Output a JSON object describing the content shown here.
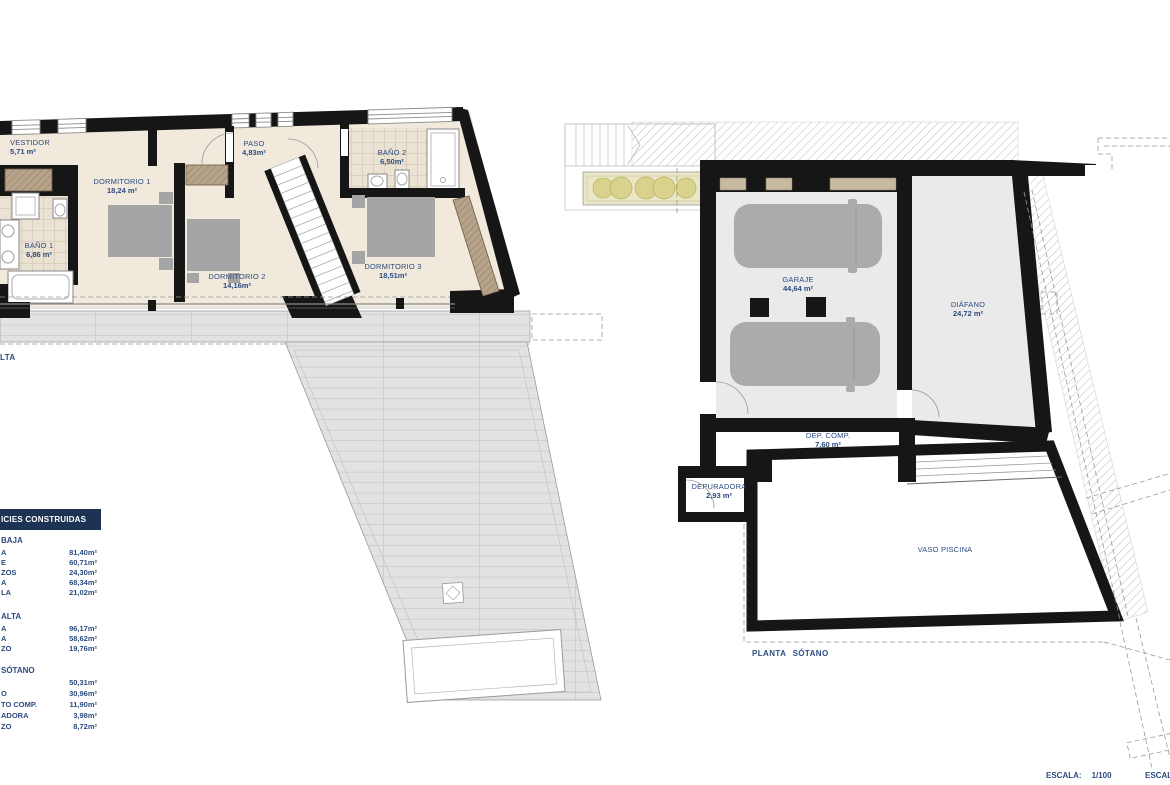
{
  "colors": {
    "label_blue": "#2d4b80",
    "table_header_bg": "#1d3353",
    "wall_black": "#161616",
    "floor_cream": "#f0e9dc",
    "terrace_gray": "#e2e2e2",
    "garage_gray": "#eaeaea",
    "car_gray": "#ababab",
    "planter_green": "#d8d28c"
  },
  "plan_alta": {
    "title_fragment": "LTA",
    "rooms": [
      {
        "name": "VESTIDOR",
        "area": "5,71 m²"
      },
      {
        "name": "BAÑO 1",
        "area": "6,86 m²"
      },
      {
        "name": "DORMITORIO 1",
        "area": "18,24 m²"
      },
      {
        "name": "PASO",
        "area": "4,83m²"
      },
      {
        "name": "BAÑO 2",
        "area": "6,50m²"
      },
      {
        "name": "DORMITORIO 2",
        "area": "14,16m²"
      },
      {
        "name": "DORMITORIO 3",
        "area": "18,51m²"
      }
    ]
  },
  "plan_sotano": {
    "title": "PLANTA SÓTANO",
    "rooms": [
      {
        "name": "GARAJE",
        "area": "44,64 m²"
      },
      {
        "name": "DIÁFANO",
        "area": "24,72 m²"
      },
      {
        "name": "DEP. COMP.",
        "area": "7,60 m²"
      },
      {
        "name": "DEPURADORA",
        "area": "2,93 m²"
      },
      {
        "name": "VASO PISCINA",
        "area": ""
      }
    ]
  },
  "surface_table": {
    "header_fragment": "ICIES CONSTRUIDAS",
    "sections": [
      {
        "title_fragment": "BAJA",
        "rows": [
          {
            "label_fragment": "A",
            "value": "81,40m²"
          },
          {
            "label_fragment": "E",
            "value": "60,71m²"
          },
          {
            "label_fragment": "ZOS",
            "value": "24,30m²"
          },
          {
            "label_fragment": "A",
            "value": "68,34m²"
          },
          {
            "label_fragment": "LA",
            "value": "21,02m²"
          }
        ]
      },
      {
        "title_fragment": "ALTA",
        "rows": [
          {
            "label_fragment": "A",
            "value": "96,17m²"
          },
          {
            "label_fragment": "A",
            "value": "58,62m²"
          },
          {
            "label_fragment": "ZO",
            "value": "19,76m²"
          }
        ]
      },
      {
        "title_fragment": "SÓTANO",
        "rows": [
          {
            "label_fragment": "",
            "value": "50,31m²"
          },
          {
            "label_fragment": "O",
            "value": "30,96m²"
          },
          {
            "label_fragment": "TO COMP.",
            "value": "11,90m²"
          },
          {
            "label_fragment": "ADORA",
            "value": "3,98m²"
          },
          {
            "label_fragment": "ZO",
            "value": "8,72m²"
          }
        ]
      }
    ]
  },
  "scale": {
    "left_label": "ESCALA:",
    "left_value": "1/100",
    "right_fragment": "ESCALA:"
  }
}
